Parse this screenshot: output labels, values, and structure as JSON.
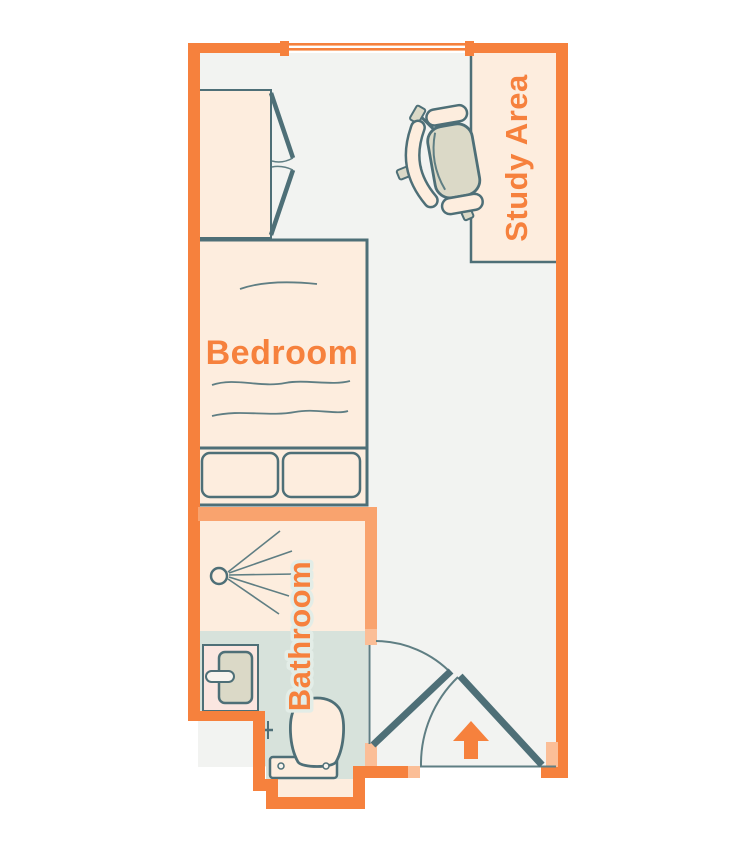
{
  "floorplan": {
    "title": "Studio room floor plan",
    "rooms": {
      "bedroom": {
        "label": "Bedroom"
      },
      "bathroom": {
        "label": "Bathroom"
      },
      "study": {
        "label": "Study Area"
      }
    },
    "furniture": [
      "wardrobe",
      "bed",
      "pillows",
      "desk",
      "office-chair",
      "shower",
      "sink",
      "toilet"
    ],
    "features": [
      "window",
      "bathroom-door",
      "entry-door",
      "entry-arrow"
    ],
    "entry": {
      "arrow_direction": "up"
    },
    "colors": {
      "wall": "#F6813D",
      "interior_wall": "#F9A36E",
      "door_jamb": "#FBBE97",
      "furniture_fill": "#FDEDDE",
      "sink_counter": "#FBE6E0",
      "fixture_fill": "#DBD9C7",
      "floor": "#F2F3F1",
      "bathroom_floor": "#D7E2DB",
      "outline": "#4E6F77",
      "label_text": "#F6813D",
      "label_halo": "#E3EDE7"
    }
  }
}
